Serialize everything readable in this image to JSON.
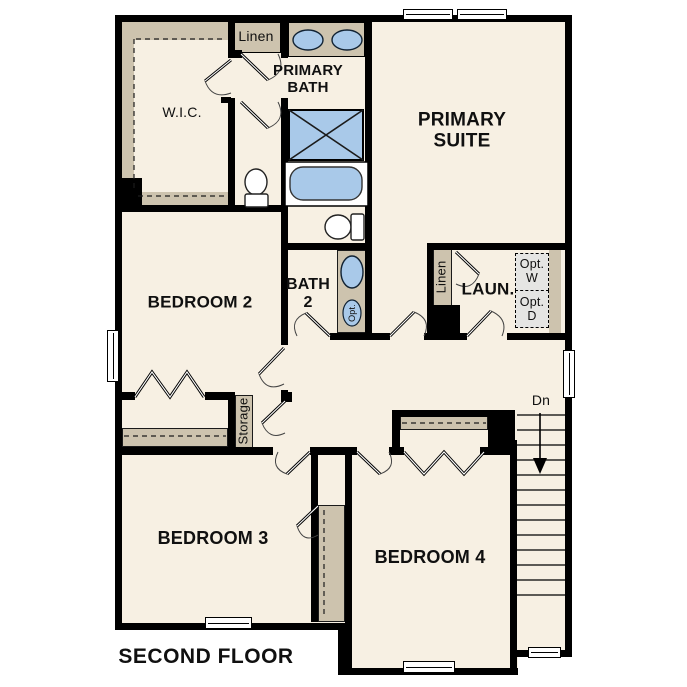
{
  "plan": {
    "title": "SECOND FLOOR",
    "floor_level": "Second Floor",
    "labels": {
      "wic": "W.I.C.",
      "linen_top": "Linen",
      "primary_bath": "PRIMARY\nBATH",
      "primary_suite": "PRIMARY\nSUITE",
      "bedroom2": "BEDROOM 2",
      "bath2": "BATH\n2",
      "opt_sink": "Opt.",
      "linen_laundry": "Linen",
      "laundry": "LAUN.",
      "opt_washer": "Opt.\nW",
      "opt_dryer": "Opt.\nD",
      "storage": "Storage",
      "down": "Dn",
      "bedroom3": "BEDROOM 3",
      "bedroom4": "BEDROOM 4"
    },
    "colors": {
      "floor": "#f7f0e3",
      "wall": "#000000",
      "cabinet_tan": "#cdc3ae",
      "fixture_blue": "#a9c9e9",
      "appliance_gray": "#e5e5e3",
      "background": "#ffffff"
    }
  }
}
